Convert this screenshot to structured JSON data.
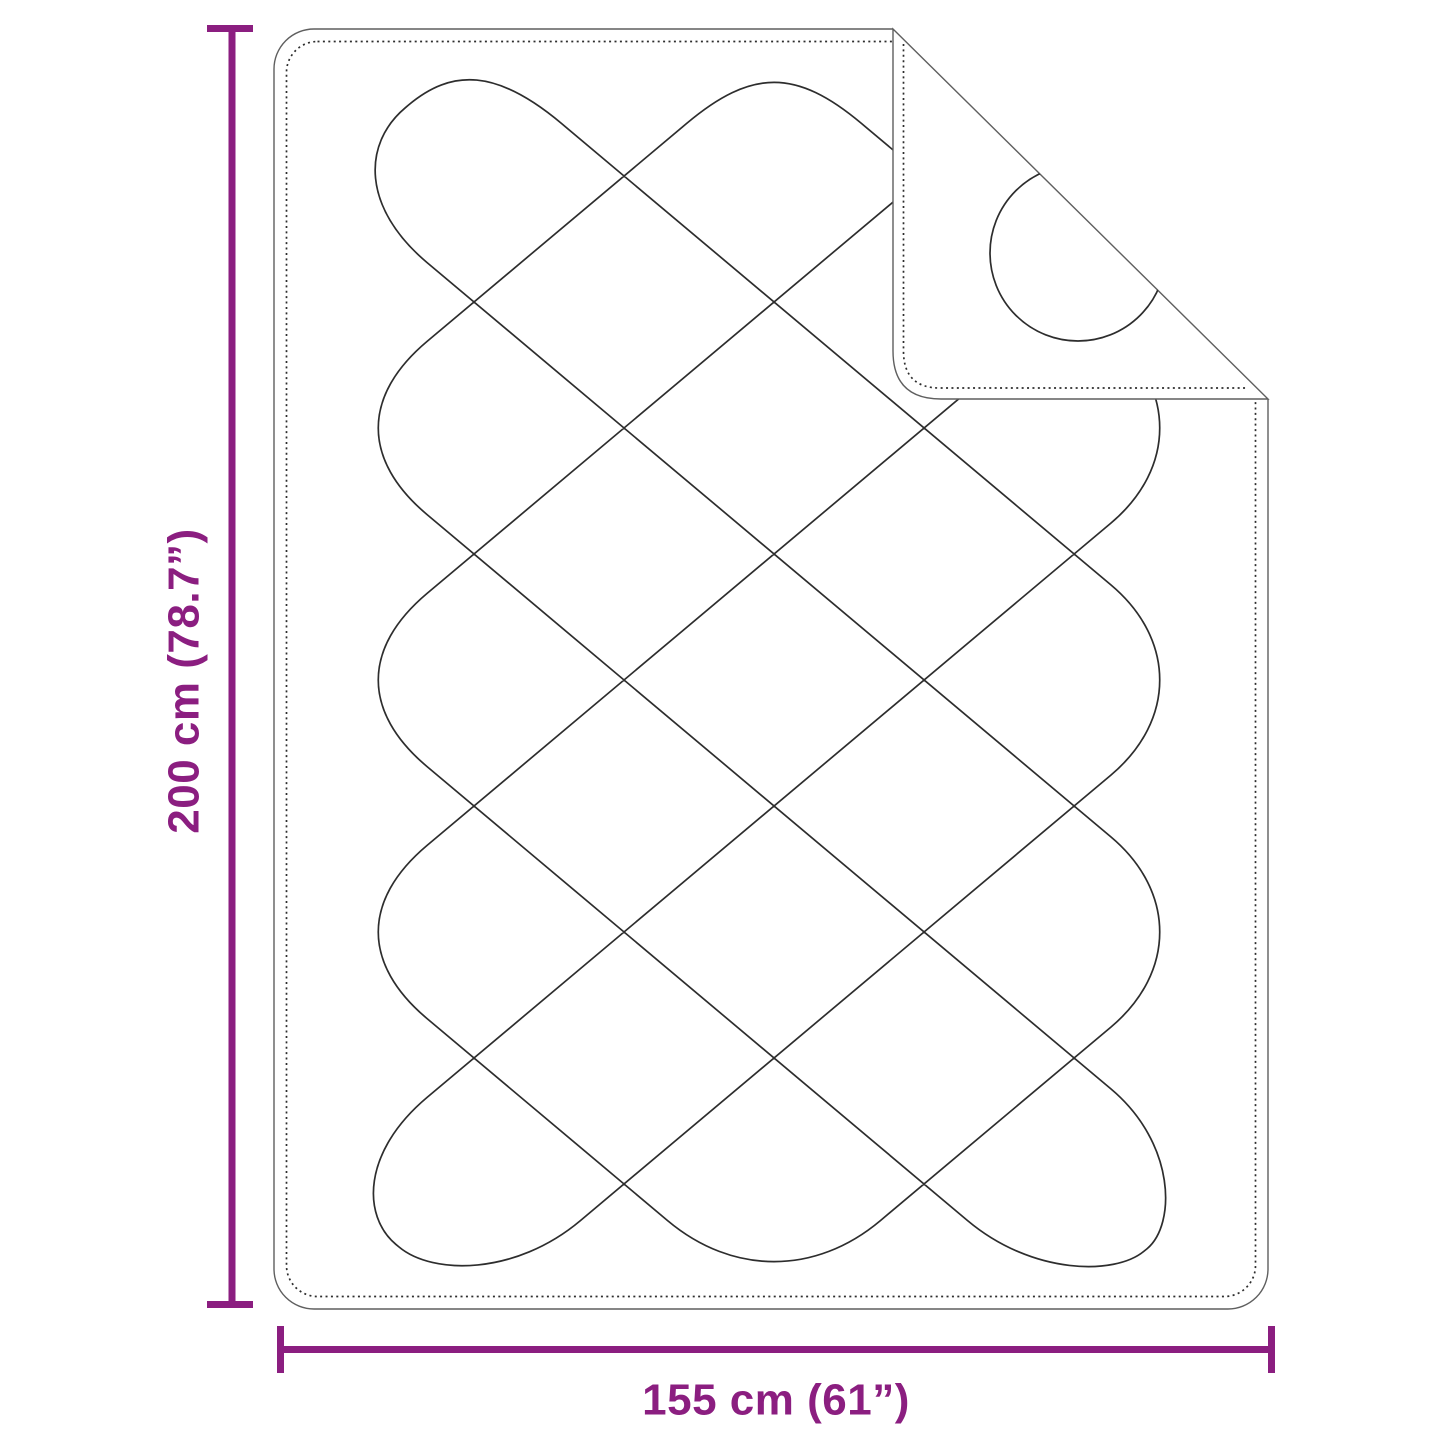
{
  "diagram": {
    "title": "Quilted blanket dimension diagram",
    "height_label": "200 cm (78.7”)",
    "width_label": "155 cm (61”)"
  },
  "colors": {
    "dimension_accent": "#8B1E80",
    "drawing_outline": "#5f5f5f",
    "stitch_line": "#2d2d2d",
    "background": "#ffffff"
  }
}
